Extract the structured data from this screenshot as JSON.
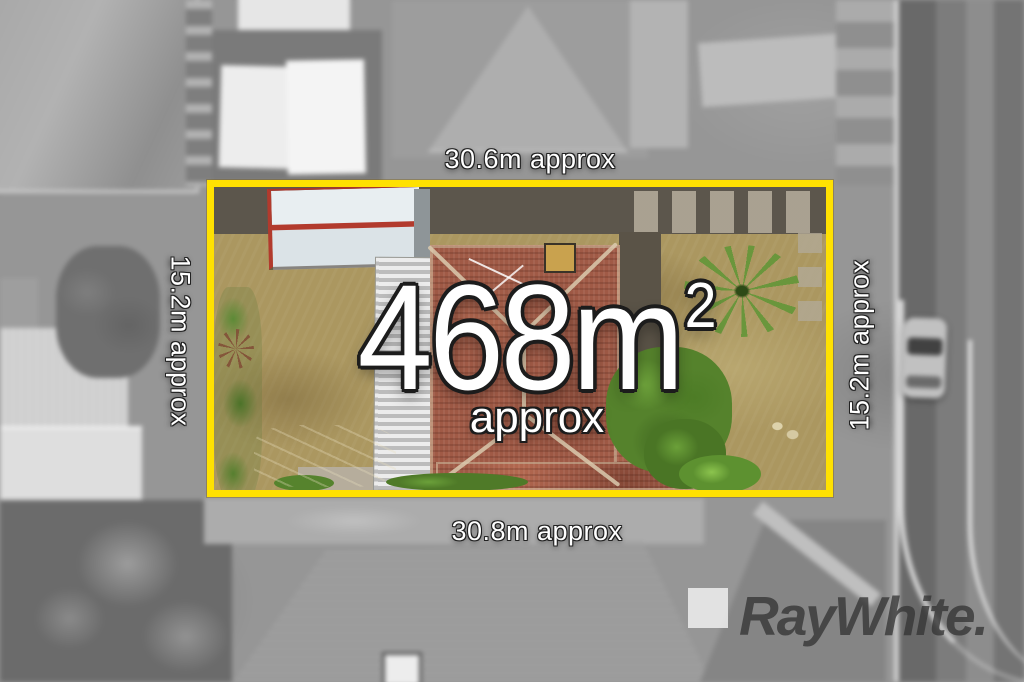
{
  "image": {
    "kind": "aerial-property-photo"
  },
  "dimensions": {
    "top": "30.6m approx",
    "bottom": "30.8m approx",
    "left": "15.2m approx",
    "right": "15.2m approx"
  },
  "area": {
    "value": "468",
    "unit": "m",
    "exponent": "2",
    "qualifier": "approx"
  },
  "branding": {
    "agency_wordmark": "RayWhite."
  },
  "colors": {
    "boundary_yellow": "#FFE101",
    "label_text": "#FFFFFF",
    "label_outline": "#1C1C1C",
    "logo_text": "#343434",
    "roof_terracotta": "#A05A46",
    "lawn_tan": "#AB9760"
  }
}
